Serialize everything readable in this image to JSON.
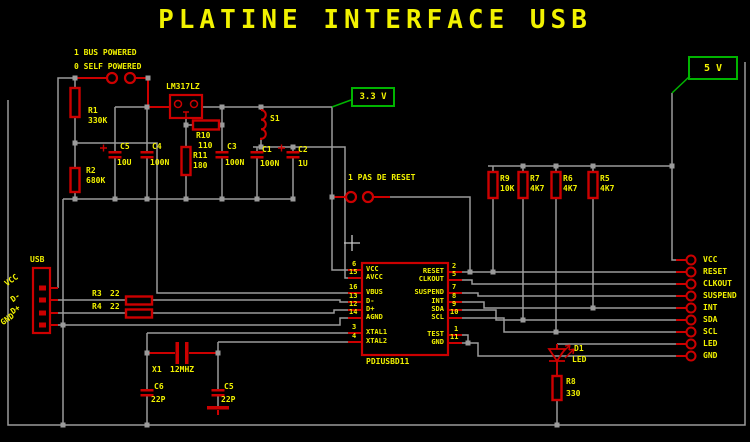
{
  "title": "PLATINE INTERFACE USB",
  "options": {
    "bus": "1 BUS POWERED",
    "self": "0 SELF POWERED",
    "reset": "1 PAS DE RESET"
  },
  "supplies": {
    "v33": "3.3 V",
    "v5": "5 V"
  },
  "regulator": {
    "ref": "LM317LZ"
  },
  "components": {
    "r1": {
      "ref": "R1",
      "value": "330K"
    },
    "r2": {
      "ref": "R2",
      "value": "680K"
    },
    "r3": {
      "ref": "R3",
      "value": "22"
    },
    "r4": {
      "ref": "R4",
      "value": "22"
    },
    "r5": {
      "ref": "R5",
      "value": "4K7"
    },
    "r6": {
      "ref": "R6",
      "value": "4K7"
    },
    "r7": {
      "ref": "R7",
      "value": "4K7"
    },
    "r8": {
      "ref": "R8",
      "value": "330"
    },
    "r9": {
      "ref": "R9",
      "value": "10K"
    },
    "r10": {
      "ref": "R10",
      "value": "110"
    },
    "r11": {
      "ref": "R11",
      "value": "180"
    },
    "c1": {
      "ref": "C1",
      "value": "100N"
    },
    "c2": {
      "ref": "C2",
      "value": "1U"
    },
    "c3": {
      "ref": "C3",
      "value": "100N"
    },
    "c4": {
      "ref": "C4",
      "value": "100N"
    },
    "c5": {
      "ref": "C5",
      "value": "10U"
    },
    "c6": {
      "ref": "C6",
      "value": "22P"
    },
    "c5b": {
      "ref": "C5",
      "value": "22P"
    },
    "s1": {
      "ref": "S1"
    },
    "x1": {
      "ref": "X1",
      "value": "12MHZ"
    },
    "d1": {
      "ref": "D1",
      "value": "LED"
    }
  },
  "ic": {
    "name": "PDIUSBD11",
    "left_pins": [
      {
        "num": "6",
        "label": "VCC"
      },
      {
        "num": "15",
        "label": "AVCC"
      },
      {
        "num": "16",
        "label": "VBUS"
      },
      {
        "num": "13",
        "label": "D-"
      },
      {
        "num": "12",
        "label": "D+"
      },
      {
        "num": "14",
        "label": "AGND"
      },
      {
        "num": "3",
        "label": "XTAL1"
      },
      {
        "num": "4",
        "label": "XTAL2"
      }
    ],
    "right_pins": [
      {
        "num": "2",
        "label": "RESET"
      },
      {
        "num": "5",
        "label": "CLKOUT"
      },
      {
        "num": "7",
        "label": "SUSPEND"
      },
      {
        "num": "8",
        "label": "INT"
      },
      {
        "num": "9",
        "label": "SDA"
      },
      {
        "num": "10",
        "label": "SCL"
      },
      {
        "num": "1",
        "label": "TEST"
      },
      {
        "num": "11",
        "label": "GND"
      }
    ]
  },
  "usb": {
    "label": "USB",
    "pins": [
      "VCC",
      "D-",
      "D+",
      "GND"
    ]
  },
  "right_connector": {
    "labels": [
      "VCC",
      "RESET",
      "CLKOUT",
      "SUSPEND",
      "INT",
      "SDA",
      "SCL",
      "LED",
      "GND"
    ]
  },
  "colors": {
    "wire": "#9b9b9b",
    "component": "#cc0000",
    "text": "#f2f200",
    "supply": "#00b400"
  }
}
